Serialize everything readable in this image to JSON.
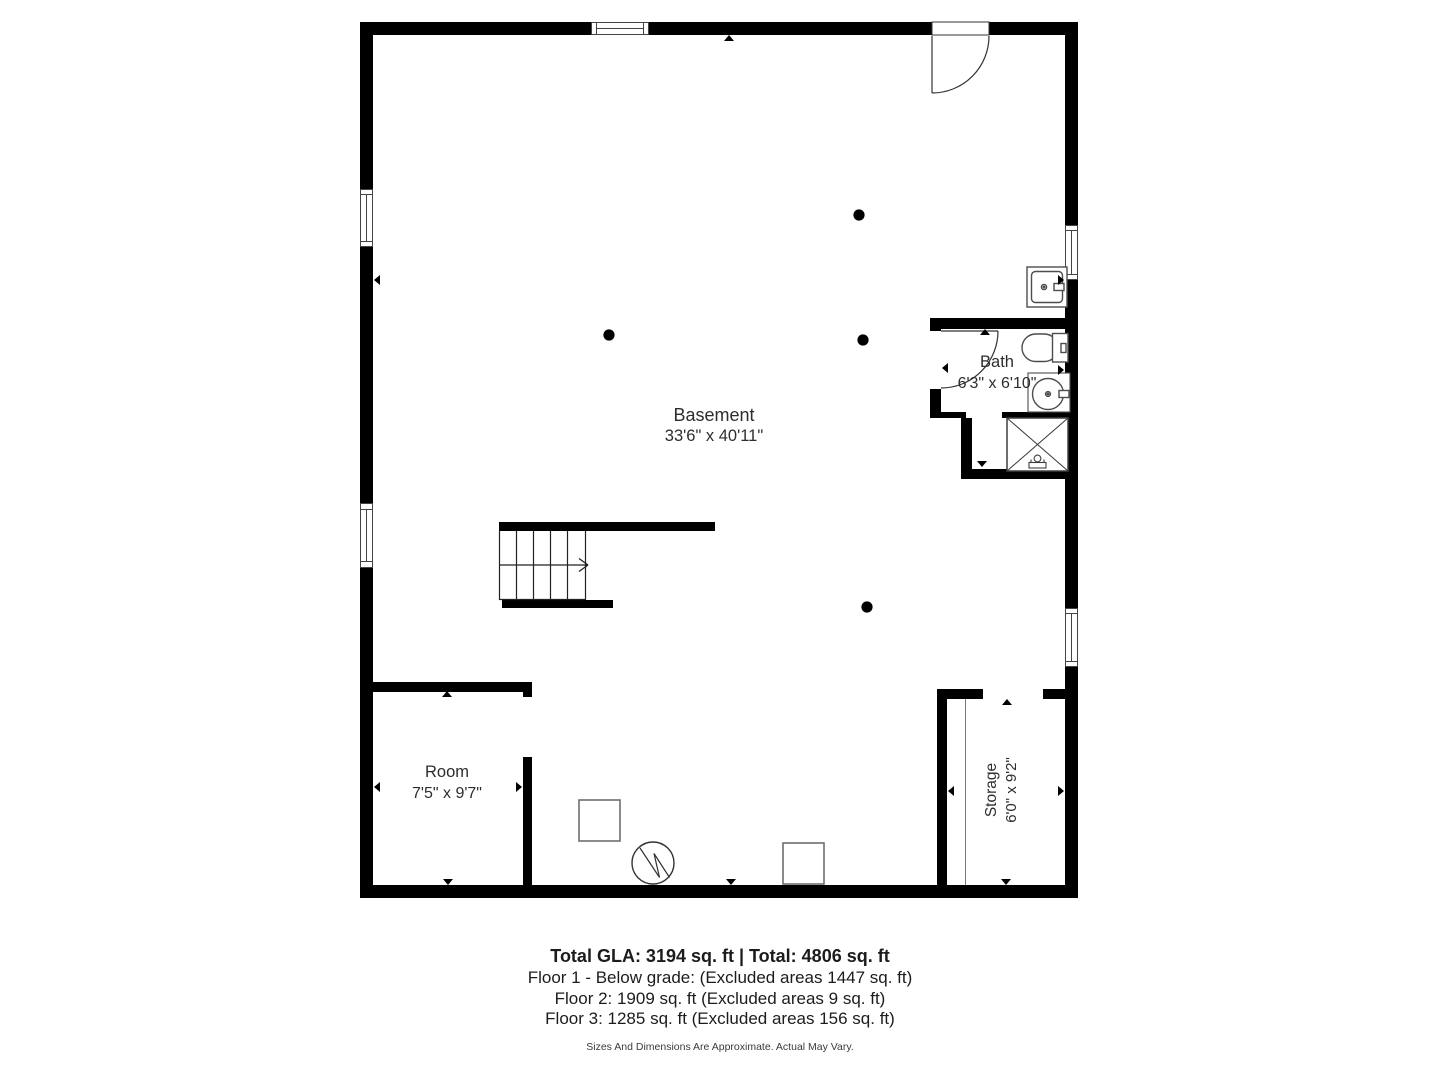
{
  "rooms": {
    "basement": {
      "name": "Basement",
      "dimensions": "33'6\" x 40'11\""
    },
    "bath": {
      "name": "Bath",
      "dimensions": "6'3\" x 6'10\""
    },
    "room": {
      "name": "Room",
      "dimensions": "7'5\" x 9'7\""
    },
    "storage": {
      "name": "Storage",
      "dimensions": "6'0\" x 9'2\""
    }
  },
  "summary": {
    "total": "Total GLA: 3194 sq. ft | Total: 4806 sq. ft",
    "floor1": "Floor 1 - Below grade: (Excluded areas 1447 sq. ft)",
    "floor2": "Floor 2: 1909 sq. ft (Excluded areas 9 sq. ft)",
    "floor3": "Floor 3: 1285 sq. ft (Excluded areas 156 sq. ft)",
    "disclaimer": "Sizes And Dimensions Are Approximate. Actual May Vary."
  },
  "fixtures": [
    "utility-sink",
    "toilet",
    "bathroom-sink",
    "shower",
    "furnace",
    "water-heater",
    "equipment-box"
  ],
  "features": [
    "entry-door",
    "bath-door",
    "stairs",
    "windows",
    "support-columns"
  ],
  "colors": {
    "wall": "#000000",
    "fixture-outline": "#555555",
    "window-frame": "#444444",
    "text": "#2d2d2d",
    "background": "#ffffff"
  }
}
